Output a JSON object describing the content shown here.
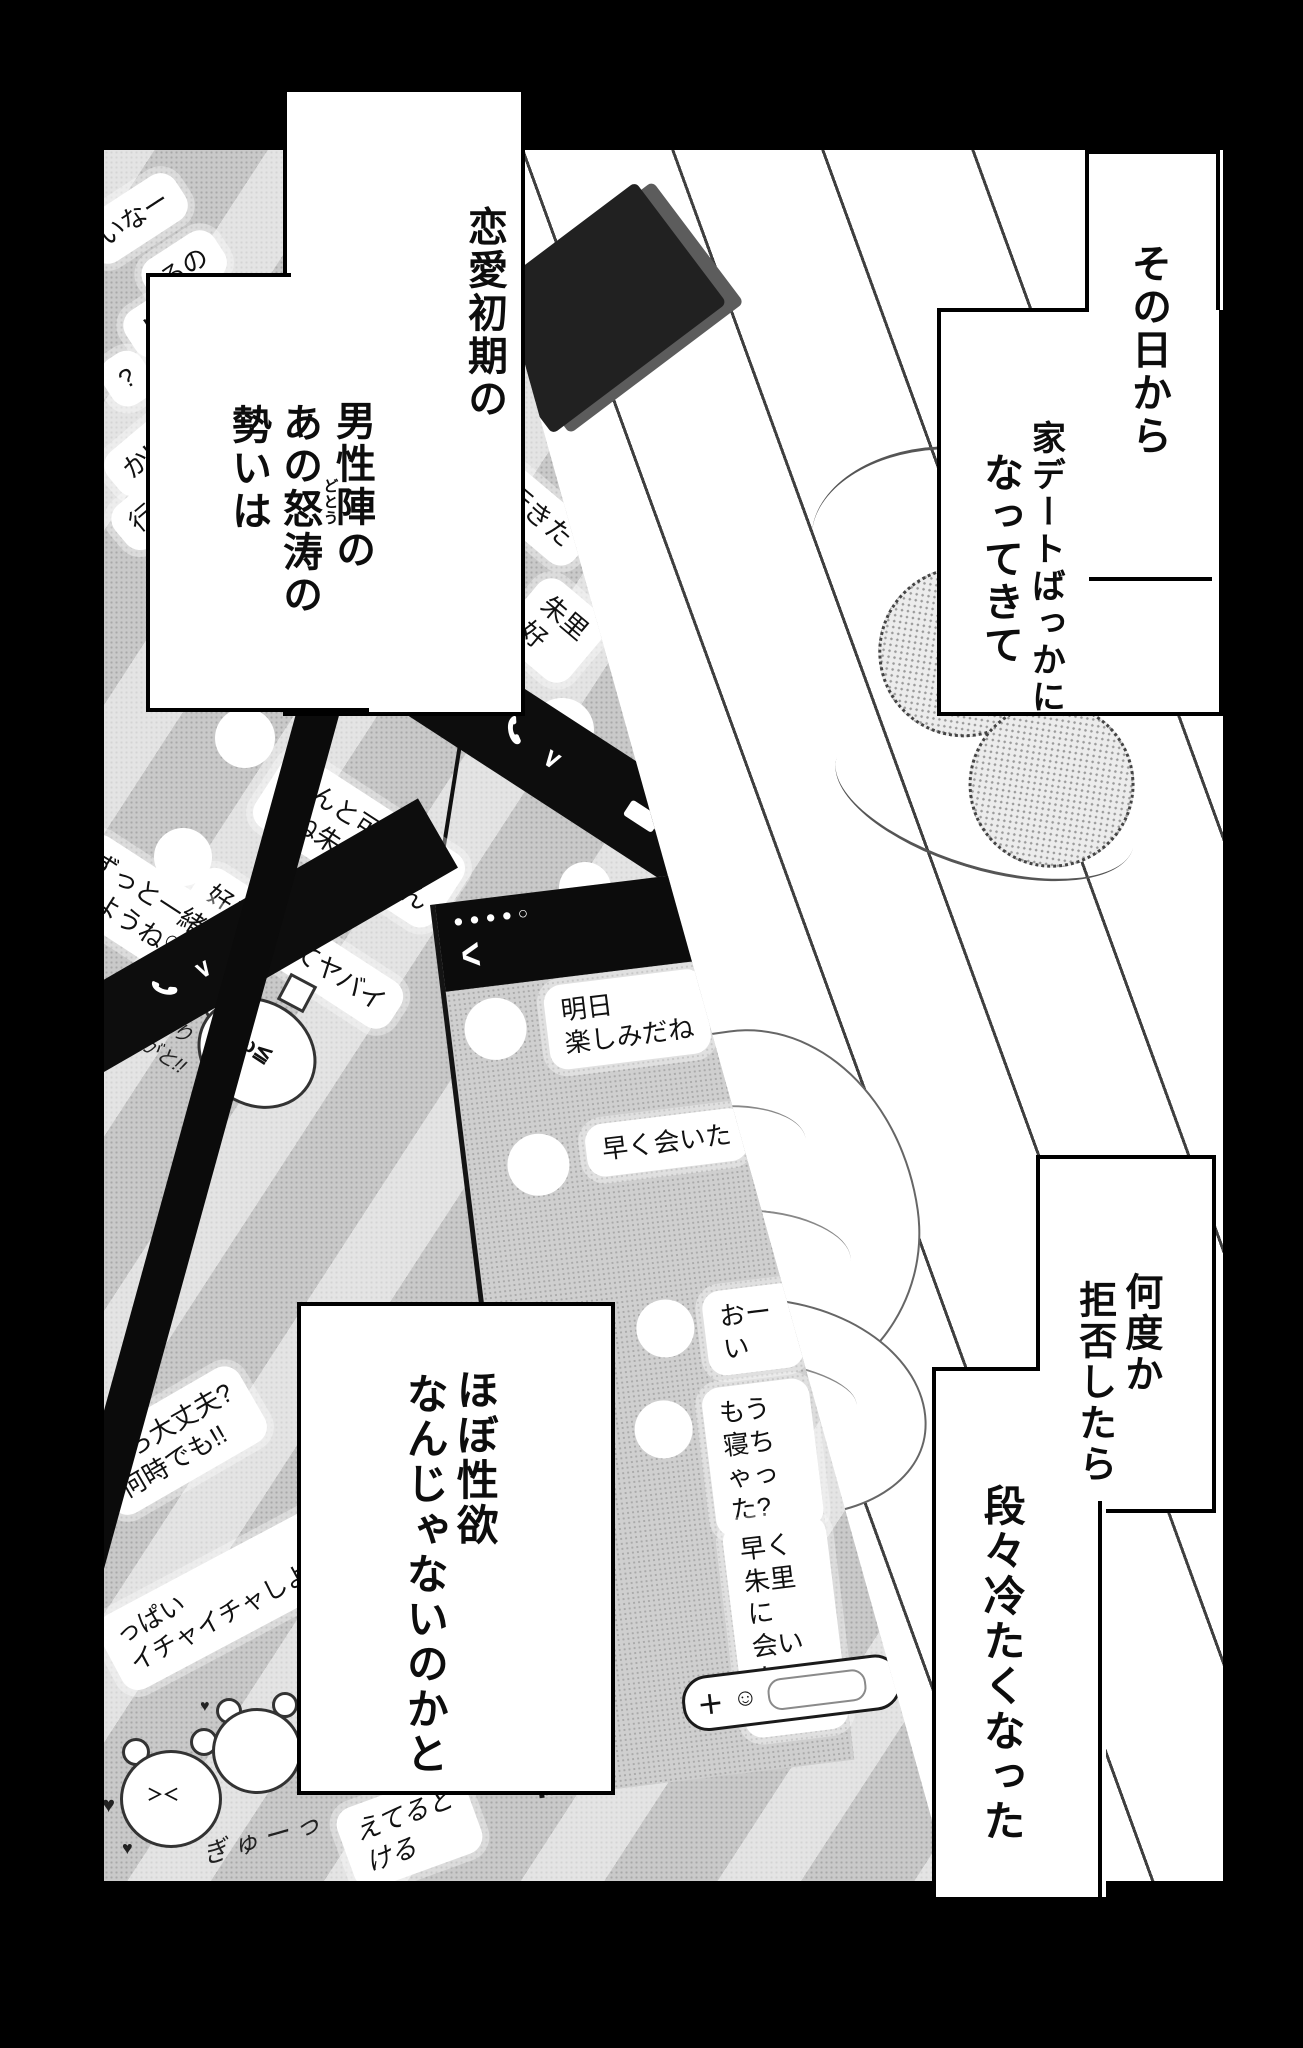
{
  "colors": {
    "page_bg": "#000000",
    "panel_bg": "#ffffff",
    "tone_gray": "#c9c9c9",
    "band_black": "#0b0b0b",
    "bubble_white": "#ffffff",
    "text": "#111111"
  },
  "narration": {
    "box1": {
      "lines": [
        "恋愛初期の",
        "男性陣の",
        "あの怒涛の",
        "勢いは"
      ],
      "furigana": "どとう"
    },
    "box2": {
      "lines": [
        "その日から",
        "家デートばっかに",
        "なってきて"
      ]
    },
    "box3": {
      "lines": [
        "何度か",
        "拒否したら",
        "段々冷たくなった"
      ]
    },
    "box4": {
      "lines": [
        "ほぼ性欲",
        "なんじゃないのかと"
      ]
    }
  },
  "chat": {
    "phone_top_left": {
      "fragments": [
        "いなー",
        "るの",
        "し",
        "?",
        "かい",
        "行"
      ]
    },
    "phone_tilted": {
      "bubbles": [
        "どこ行きた",
        "朱里\n好"
      ]
    },
    "phone_call": {
      "bubbles": [
        "ほんと可愛い\nよね朱里ちゃん",
        "好きすぎてヤバイ",
        "ずっと一緒に\nいようね♡"
      ],
      "cat_sticker": {
        "text": "あり\nがと!!",
        "face": "≧ω≦",
        "hearts": "♡♡"
      }
    },
    "phone_main": {
      "status_dots": "●●●●○",
      "back": "<",
      "bubbles": [
        "明日\n楽しみだね",
        "早く会いた",
        "おーい",
        "もう\n寝ちゃった?",
        "早く朱里に\n会いたいよ♡"
      ],
      "input": {
        "plus": "＋",
        "smiley": "☺"
      }
    },
    "phone_bottom_left": {
      "bubbles": [
        "なら大丈夫?\n何時でも!!",
        "っぱい\nイチャイチャしよう",
        "えてると\nける"
      ],
      "bear_sticker": {
        "text": "ぎゅーっ",
        "face": "＞＜"
      },
      "hearts": "♥"
    }
  },
  "icons": {
    "chevron_down": "∨"
  }
}
